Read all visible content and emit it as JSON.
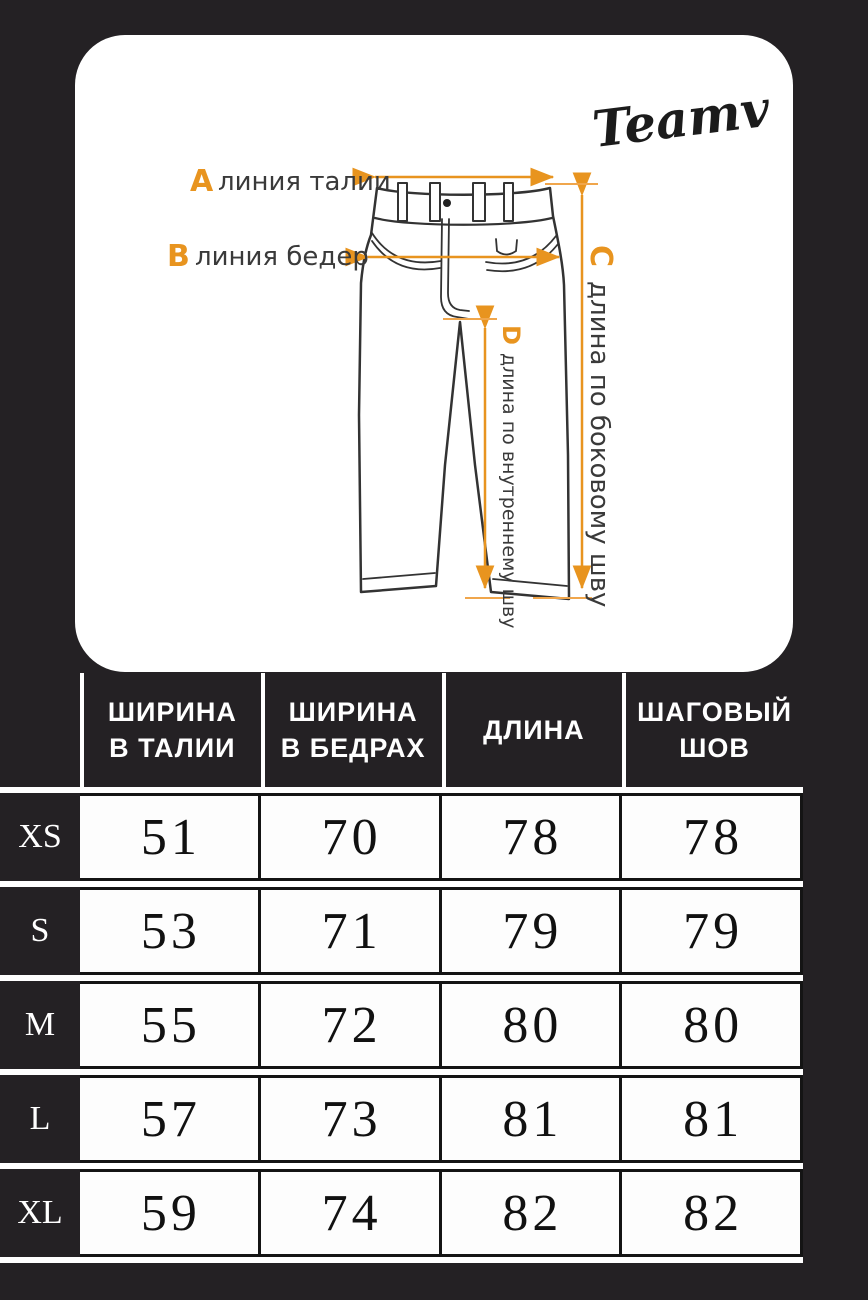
{
  "page": {
    "background": "#242124",
    "accent": "#E8941F",
    "card_background": "#FFFFFF"
  },
  "brand": {
    "logo_text": "Teamv"
  },
  "diagram": {
    "label_a": {
      "letter": "A",
      "text": "линия талии"
    },
    "label_b": {
      "letter": "B",
      "text": "линия бедер"
    },
    "label_c": {
      "letter": "C",
      "text": "длина по боковому шву"
    },
    "label_d": {
      "letter": "D",
      "text": "длина по внутреннему шву"
    }
  },
  "size_table": {
    "columns": [
      {
        "line1": "ШИРИНА",
        "line2": "В ТАЛИИ"
      },
      {
        "line1": "ШИРИНА",
        "line2": "В БЕДРАХ"
      },
      {
        "line1": "ДЛИНА",
        "line2": ""
      },
      {
        "line1": "ШАГОВЫЙ",
        "line2": "ШОВ"
      }
    ],
    "rows": [
      {
        "size": "XS",
        "values": [
          51,
          70,
          78,
          78
        ]
      },
      {
        "size": "S",
        "values": [
          53,
          71,
          79,
          79
        ]
      },
      {
        "size": "M",
        "values": [
          55,
          72,
          80,
          80
        ]
      },
      {
        "size": "L",
        "values": [
          57,
          73,
          81,
          81
        ]
      },
      {
        "size": "XL",
        "values": [
          59,
          74,
          82,
          82
        ]
      }
    ]
  }
}
